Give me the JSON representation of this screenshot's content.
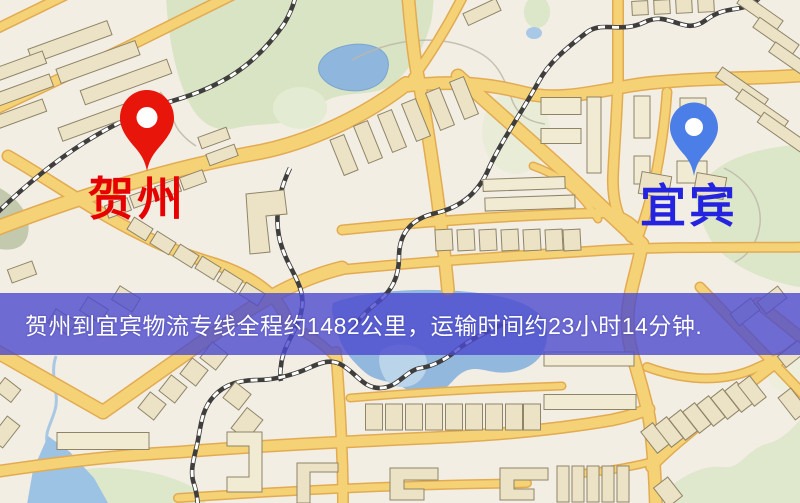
{
  "map": {
    "origin": {
      "label": "贺州",
      "label_color": "#e60000",
      "pin_color": "#e8150b"
    },
    "destination": {
      "label": "宜宾",
      "label_color": "#2424e0",
      "pin_color": "#4b7ee6"
    },
    "banner": {
      "text": "贺州到宜宾物流专线全程约1482公里，运输时间约23小时14分钟.",
      "distance_text": "约1482公里",
      "duration_text": "约23小时14分钟",
      "background_color": "#4c4ace",
      "text_color": "#ffffff"
    },
    "theme": {
      "land_color": "#f3eee4",
      "road_color": "#f5d275",
      "road_casing_color": "#e2ab52",
      "park_color": "#d9e4c4",
      "water_color": "#93b8de",
      "building_color": "#ece3c6",
      "railway_color": "#3f3e3c"
    }
  }
}
